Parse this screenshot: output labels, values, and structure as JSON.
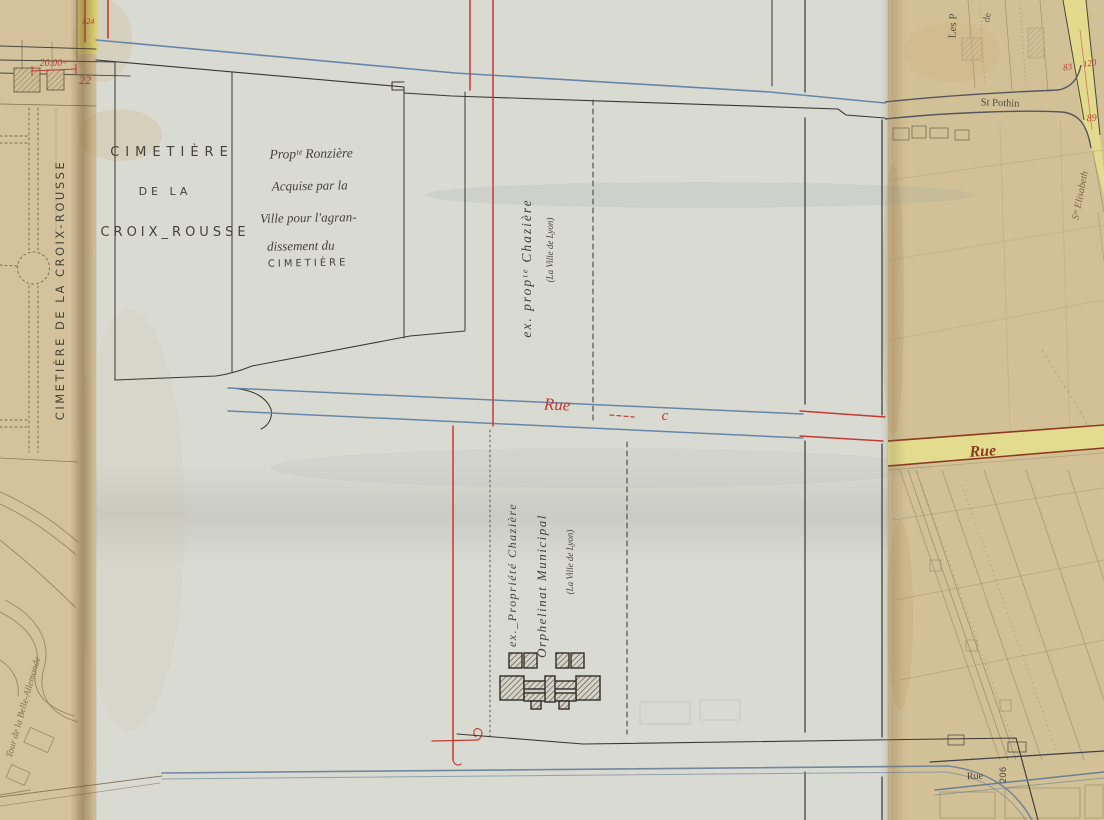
{
  "colors": {
    "tan_paper": "#d4c29c",
    "tan_paper_right": "#d2c096",
    "overlay_paper": "#d9dad2",
    "black_ink": "#3a382f",
    "red_ink": "#c23b35",
    "dark_red_street": "#8e3a22",
    "blue_street_line": "#6787a8",
    "yellow_street": "#e4dd8d"
  },
  "labels": {
    "cimetiere_vertical": "CIMETIÈRE DE LA CROIX-ROUSSE",
    "cimetiere_block": [
      "CIMETIÈRE",
      "DE LA",
      "CROIX_ROUSSE"
    ],
    "ronziere_note": [
      "Propᵗᵉ Ronzière",
      "Acquise par la",
      "Ville pour l'agran-",
      "dissement du",
      "CIMETIÈRE"
    ],
    "chaziere_nord": {
      "main": "ex. propᵗᵉ Chazière",
      "sub": "(La Ville de Lyon)"
    },
    "chaziere_sud": {
      "line1": "ex._Propriété Chazière",
      "line2": "Orphelinat Municipal",
      "sub": "(La Ville de Lyon)"
    },
    "rue_c": {
      "rue": "Rue",
      "letter": "c"
    },
    "rue_est": "Rue",
    "rue_sud": "Rue",
    "st_pothin": "St Pothin",
    "ste_elisabeth": "Sᵗᵉ Elisabeth",
    "les_p": "Les P",
    "de_fragment": "de",
    "tour_belle_allemande": "Tour de la Belle-Allemande"
  },
  "annotations": {
    "cote_20m": "20.00ᵐ",
    "num_22": "22",
    "num_124": "124",
    "num_83": "83",
    "num_120": "120",
    "num_89": "89",
    "num_206": "206"
  }
}
